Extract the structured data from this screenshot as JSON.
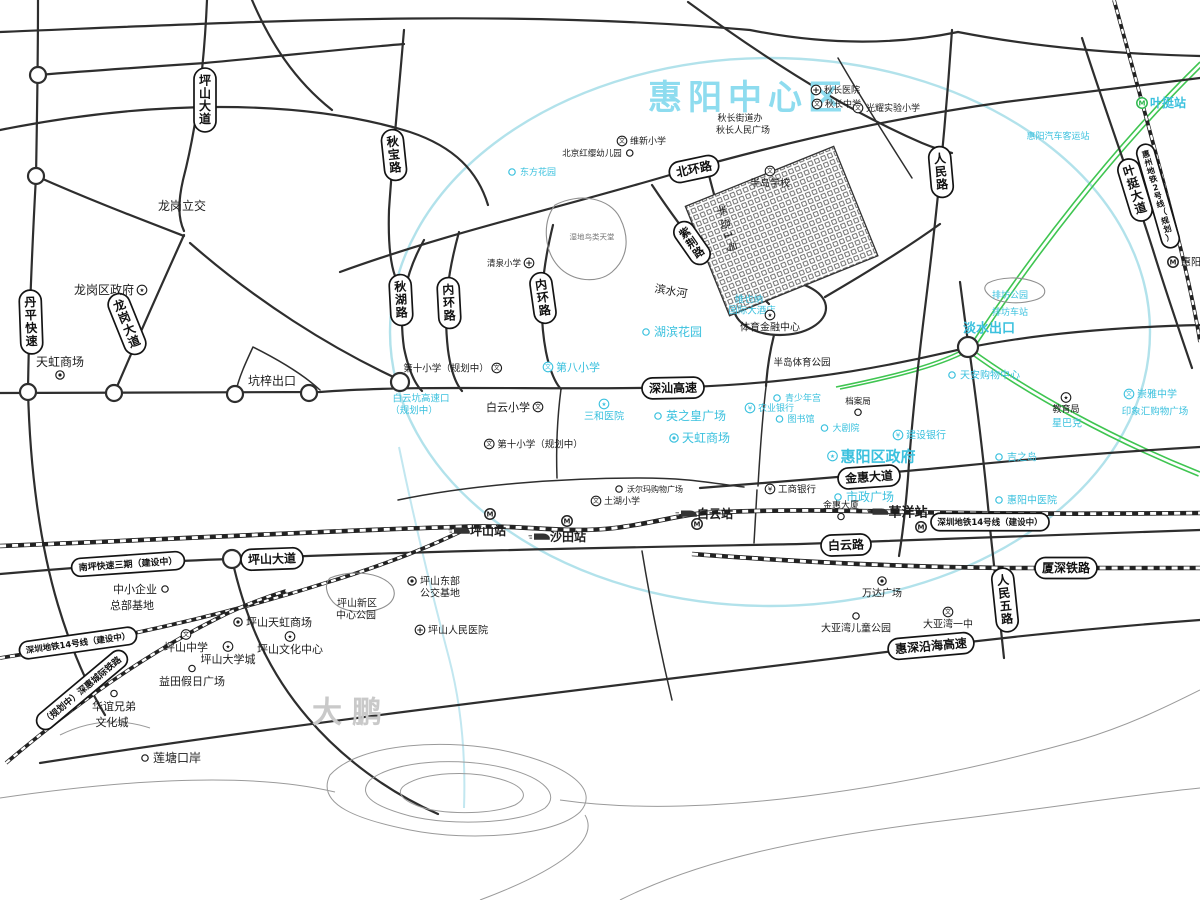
{
  "map": {
    "colors": {
      "cyan": "#3bc1de",
      "black": "#1c1c1c",
      "green": "#3fc551",
      "boundary": "#aadfe9"
    },
    "region_name": "惠阳中心区",
    "road_pills": [
      {
        "t": "坪山大道",
        "x": 205,
        "y": 100,
        "rot": 90,
        "fs": 12
      },
      {
        "t": "秋宝路",
        "x": 394,
        "y": 155,
        "rot": 84,
        "fs": 12
      },
      {
        "t": "秋湖路",
        "x": 401,
        "y": 300,
        "rot": 87,
        "fs": 12
      },
      {
        "t": "内环路",
        "x": 449,
        "y": 303,
        "rot": 87,
        "fs": 12
      },
      {
        "t": "内环路",
        "x": 543,
        "y": 298,
        "rot": 82,
        "fs": 12
      },
      {
        "t": "北环路",
        "x": 694,
        "y": 169,
        "rot": -12,
        "fs": 12
      },
      {
        "t": "紫荆路",
        "x": 692,
        "y": 243,
        "rot": 55,
        "fs": 11
      },
      {
        "t": "人民路",
        "x": 941,
        "y": 172,
        "rot": 85,
        "fs": 12
      },
      {
        "t": "深汕高速",
        "x": 673,
        "y": 388,
        "rot": -1,
        "fs": 12
      },
      {
        "t": "龙岗大道",
        "x": 127,
        "y": 324,
        "rot": 68,
        "fs": 12
      },
      {
        "t": "丹平快速",
        "x": 31,
        "y": 322,
        "rot": 88,
        "fs": 12
      },
      {
        "t": "金惠大道",
        "x": 869,
        "y": 477,
        "rot": -4,
        "fs": 12
      },
      {
        "t": "白云路",
        "x": 846,
        "y": 545,
        "rot": -2,
        "fs": 12
      },
      {
        "t": "坪山大道",
        "x": 272,
        "y": 559,
        "rot": -2,
        "fs": 12
      },
      {
        "t": "南坪快速三期（建设中）",
        "x": 128,
        "y": 564,
        "rot": -4,
        "fs": 9
      },
      {
        "t": "深圳地铁14号线（建设中）",
        "x": 78,
        "y": 643,
        "rot": -8,
        "fs": 8.5
      },
      {
        "t": "深圳地铁14号线（建设中）",
        "x": 990,
        "y": 522,
        "rot": 0,
        "fs": 8.5
      },
      {
        "t": "（规划中）深惠城际铁路",
        "x": 82,
        "y": 690,
        "rot": -40,
        "fs": 9
      },
      {
        "t": "厦深铁路",
        "x": 1066,
        "y": 568,
        "rot": 0,
        "fs": 12
      },
      {
        "t": "惠深沿海高速",
        "x": 931,
        "y": 646,
        "rot": -5,
        "fs": 12
      },
      {
        "t": "人民五路",
        "x": 1005,
        "y": 600,
        "rot": 84,
        "fs": 12
      },
      {
        "t": "叶挺大道",
        "x": 1135,
        "y": 190,
        "rot": 73,
        "fs": 12
      },
      {
        "t": "惠州地铁2号线（规划）",
        "x": 1158,
        "y": 196,
        "rot": 74,
        "fs": 8
      }
    ],
    "labels": [
      {
        "t": "惠阳中心区",
        "x": 748,
        "y": 97,
        "col": "#8edcef",
        "fs": 34,
        "b": 1,
        "ls": 6
      },
      {
        "t": "大鹏",
        "x": 352,
        "y": 712,
        "col": "#c9c9c9",
        "fs": 30,
        "b": 1,
        "ls": 10
      },
      {
        "t": "秋长医院",
        "x": 842,
        "y": 90,
        "c": "k",
        "ic": "hosp",
        "ip": "l",
        "fs": 9
      },
      {
        "t": "秋长中学",
        "x": 843,
        "y": 104,
        "c": "k",
        "ic": "school",
        "ip": "l",
        "fs": 9
      },
      {
        "t": "光耀实验小学",
        "x": 893,
        "y": 108,
        "c": "k",
        "ic": "school",
        "ip": "l",
        "fs": 9
      },
      {
        "t": "秋长街道办",
        "x": 740,
        "y": 118,
        "c": "k",
        "fs": 9
      },
      {
        "t": "秋长人民广场",
        "x": 743,
        "y": 130,
        "c": "k",
        "fs": 9
      },
      {
        "t": "维新小学",
        "x": 648,
        "y": 141,
        "c": "k",
        "ic": "school",
        "ip": "l",
        "fs": 9
      },
      {
        "t": "北京红缨幼儿园",
        "x": 592,
        "y": 153,
        "c": "k",
        "ic": "dot",
        "ip": "r",
        "fs": 8.5
      },
      {
        "t": "东方花园",
        "x": 538,
        "y": 172,
        "c": "c",
        "ic": "dot",
        "ip": "l",
        "fs": 9
      },
      {
        "t": "半岛学校",
        "x": 770,
        "y": 183,
        "c": "k",
        "ic": "school",
        "ip": "t",
        "fs": 10
      },
      {
        "t": "半岛1号",
        "x": 727,
        "y": 230,
        "c": "k",
        "fs": 11,
        "rot": 75,
        "ls": 3
      },
      {
        "t": "湿地鸟类天堂",
        "x": 592,
        "y": 237,
        "col": "#777777",
        "fs": 7.5
      },
      {
        "t": "清泉小学",
        "x": 504,
        "y": 263,
        "c": "k",
        "ic": "hosp",
        "ip": "r",
        "fs": 8.5
      },
      {
        "t": "滨水河",
        "x": 671,
        "y": 291,
        "c": "k",
        "fs": 11,
        "rot": 10
      },
      {
        "t": "排坊公园",
        "x": 1010,
        "y": 295,
        "c": "c",
        "fs": 9
      },
      {
        "t": "排坊车站",
        "x": 1010,
        "y": 312,
        "c": "c",
        "fs": 9
      },
      {
        "t": "淡水出口",
        "x": 989,
        "y": 328,
        "c": "c",
        "fs": 13,
        "b": 1
      },
      {
        "t": "维也纳",
        "x": 749,
        "y": 299,
        "c": "c",
        "fs": 9.5
      },
      {
        "t": "国际大酒店",
        "x": 752,
        "y": 310,
        "c": "c",
        "fs": 9.5
      },
      {
        "t": "体育金融中心",
        "x": 770,
        "y": 327,
        "c": "k",
        "ic": "gov",
        "ip": "t",
        "fs": 10
      },
      {
        "t": "湖滨花园",
        "x": 678,
        "y": 332,
        "c": "c",
        "ic": "dot",
        "ip": "l",
        "fs": 12
      },
      {
        "t": "半岛体育公园",
        "x": 802,
        "y": 362,
        "c": "k",
        "fs": 9.5
      },
      {
        "t": "第八小学",
        "x": 578,
        "y": 367,
        "c": "c",
        "ic": "school",
        "ip": "l",
        "fs": 11
      },
      {
        "t": "第十小学（规划中）",
        "x": 446,
        "y": 368,
        "c": "k",
        "ic": "school",
        "ip": "r",
        "fs": 9.5
      },
      {
        "t": "白云坑高速口",
        "x": 421,
        "y": 398,
        "c": "c",
        "fs": 9.5
      },
      {
        "t": "（规划中）",
        "x": 414,
        "y": 410,
        "c": "c",
        "fs": 9.5
      },
      {
        "t": "白云小学",
        "x": 508,
        "y": 407,
        "c": "k",
        "ic": "school",
        "ip": "r",
        "fs": 11
      },
      {
        "t": "第十小学（规划中）",
        "x": 540,
        "y": 444,
        "c": "k",
        "ic": "school",
        "ip": "l",
        "fs": 9.5
      },
      {
        "t": "三和医院",
        "x": 604,
        "y": 416,
        "c": "c",
        "ic": "gov",
        "ip": "t",
        "fs": 10
      },
      {
        "t": "英之皇广场",
        "x": 696,
        "y": 416,
        "c": "c",
        "ic": "dot",
        "ip": "l",
        "fs": 12
      },
      {
        "t": "天虹商场",
        "x": 706,
        "y": 438,
        "c": "c",
        "ic": "shop",
        "ip": "l",
        "fs": 12
      },
      {
        "t": "惠阳区政府",
        "x": 878,
        "y": 456,
        "c": "c",
        "ic": "gov",
        "ip": "l",
        "fs": 15,
        "b": 1
      },
      {
        "t": "青少年宫",
        "x": 803,
        "y": 398,
        "c": "c",
        "ic": "dot",
        "ip": "l",
        "fs": 9
      },
      {
        "t": "农业银行",
        "x": 776,
        "y": 408,
        "c": "c",
        "ic": "bank",
        "ip": "l",
        "fs": 9
      },
      {
        "t": "图书馆",
        "x": 801,
        "y": 419,
        "c": "c",
        "ic": "dot",
        "ip": "l",
        "fs": 9
      },
      {
        "t": "大剧院",
        "x": 846,
        "y": 428,
        "c": "c",
        "ic": "dot",
        "ip": "l",
        "fs": 9
      },
      {
        "t": "档案局",
        "x": 858,
        "y": 401,
        "c": "k",
        "ic": "dot",
        "ip": "b",
        "fs": 8.5
      },
      {
        "t": "建设银行",
        "x": 926,
        "y": 435,
        "c": "c",
        "ic": "bank",
        "ip": "l",
        "fs": 10
      },
      {
        "t": "市政广场",
        "x": 870,
        "y": 497,
        "c": "c",
        "ic": "dot",
        "ip": "l",
        "fs": 12
      },
      {
        "t": "工商银行",
        "x": 797,
        "y": 489,
        "c": "k",
        "ic": "bank",
        "ip": "l",
        "fs": 9.5
      },
      {
        "t": "金惠大厦",
        "x": 841,
        "y": 505,
        "c": "k",
        "ic": "dot",
        "ip": "b",
        "fs": 9
      },
      {
        "t": "教育局",
        "x": 1066,
        "y": 409,
        "c": "k",
        "ic": "gov",
        "ip": "t",
        "fs": 9
      },
      {
        "t": "星巴克",
        "x": 1067,
        "y": 423,
        "c": "c",
        "fs": 10
      },
      {
        "t": "吉之岛",
        "x": 1022,
        "y": 457,
        "c": "c",
        "ic": "dot",
        "ip": "l",
        "fs": 10
      },
      {
        "t": "天安购物中心",
        "x": 990,
        "y": 375,
        "c": "c",
        "ic": "dot",
        "ip": "l",
        "fs": 10
      },
      {
        "t": "惠阳中医院",
        "x": 1032,
        "y": 500,
        "c": "c",
        "ic": "dot",
        "ip": "l",
        "fs": 10
      },
      {
        "t": "崇雅中学",
        "x": 1157,
        "y": 394,
        "c": "c",
        "ic": "school",
        "ip": "l",
        "fs": 10
      },
      {
        "t": "印象汇购物广场",
        "x": 1155,
        "y": 411,
        "c": "c",
        "fs": 9.5
      },
      {
        "t": "惠阳汽车客运站",
        "x": 1058,
        "y": 136,
        "c": "c",
        "fs": 9
      },
      {
        "t": "叶挺站",
        "x": 1168,
        "y": 103,
        "c": "c",
        "ic": "metrog",
        "ip": "l",
        "fs": 12,
        "b": 1
      },
      {
        "t": "惠阳",
        "x": 1191,
        "y": 262,
        "c": "k",
        "ic": "metro",
        "ip": "l",
        "fs": 10
      },
      {
        "t": "土湖小学",
        "x": 622,
        "y": 501,
        "c": "k",
        "ic": "school",
        "ip": "l",
        "fs": 9
      },
      {
        "t": "沃尔玛购物广场",
        "x": 655,
        "y": 489,
        "c": "k",
        "ic": "dot",
        "ip": "l",
        "fs": 8
      },
      {
        "t": "龙岗立交",
        "x": 182,
        "y": 206,
        "c": "k",
        "fs": 12
      },
      {
        "t": "龙岗区政府",
        "x": 104,
        "y": 290,
        "c": "k",
        "ic": "gov",
        "ip": "r",
        "fs": 12
      },
      {
        "t": "天虹商场",
        "x": 60,
        "y": 362,
        "c": "k",
        "ic": "shop",
        "ip": "b",
        "fs": 12
      },
      {
        "t": "坑梓出口",
        "x": 272,
        "y": 381,
        "c": "k",
        "fs": 12
      },
      {
        "t": "中小企业",
        "x": 135,
        "y": 589,
        "c": "k",
        "ic": "dot",
        "ip": "r",
        "fs": 11
      },
      {
        "t": "总部基地",
        "x": 132,
        "y": 605,
        "c": "k",
        "fs": 11
      },
      {
        "t": "坪山东部",
        "x": 440,
        "y": 581,
        "c": "k",
        "ic": "shop",
        "ip": "l",
        "fs": 10
      },
      {
        "t": "公交基地",
        "x": 440,
        "y": 593,
        "c": "k",
        "fs": 10
      },
      {
        "t": "坪山新区",
        "x": 357,
        "y": 603,
        "c": "k",
        "fs": 10
      },
      {
        "t": "中心公园",
        "x": 356,
        "y": 615,
        "c": "k",
        "fs": 10
      },
      {
        "t": "坪山天虹商场",
        "x": 279,
        "y": 622,
        "c": "k",
        "ic": "shop",
        "ip": "l",
        "fs": 11
      },
      {
        "t": "坪山人民医院",
        "x": 458,
        "y": 630,
        "c": "k",
        "ic": "hosp",
        "ip": "l",
        "fs": 10
      },
      {
        "t": "坪山中学",
        "x": 186,
        "y": 647,
        "c": "k",
        "ic": "school",
        "ip": "t",
        "fs": 11
      },
      {
        "t": "坪山大学城",
        "x": 228,
        "y": 659,
        "c": "k",
        "ic": "gov",
        "ip": "t",
        "fs": 11
      },
      {
        "t": "坪山文化中心",
        "x": 290,
        "y": 649,
        "c": "k",
        "ic": "gov",
        "ip": "t",
        "fs": 11
      },
      {
        "t": "益田假日广场",
        "x": 192,
        "y": 681,
        "c": "k",
        "ic": "dot",
        "ip": "t",
        "fs": 11
      },
      {
        "t": "华谊兄弟",
        "x": 114,
        "y": 706,
        "c": "k",
        "ic": "dot",
        "ip": "t",
        "fs": 11
      },
      {
        "t": "文化城",
        "x": 112,
        "y": 722,
        "c": "k",
        "fs": 11
      },
      {
        "t": "莲塘口岸",
        "x": 177,
        "y": 758,
        "c": "k",
        "ic": "dot",
        "ip": "l",
        "fs": 12
      },
      {
        "t": "万达广场",
        "x": 882,
        "y": 593,
        "c": "k",
        "ic": "shop",
        "ip": "t",
        "fs": 10
      },
      {
        "t": "大亚湾儿童公园",
        "x": 856,
        "y": 628,
        "c": "k",
        "ic": "dot",
        "ip": "t",
        "fs": 10
      },
      {
        "t": "大亚湾一中",
        "x": 948,
        "y": 624,
        "c": "k",
        "ic": "school",
        "ip": "t",
        "fs": 10
      },
      {
        "t": "坪山站",
        "x": 488,
        "y": 531,
        "c": "k",
        "ic": "train",
        "ip": "l",
        "fs": 12,
        "b": 1
      },
      {
        "t": "沙田站",
        "x": 568,
        "y": 537,
        "c": "k",
        "ic": "train",
        "ip": "l",
        "fs": 12,
        "b": 1
      },
      {
        "t": "白云站",
        "x": 715,
        "y": 514,
        "c": "k",
        "ic": "train",
        "ip": "l",
        "fs": 12,
        "b": 1
      },
      {
        "t": "草洋站",
        "x": 908,
        "y": 512,
        "c": "k",
        "ic": "train",
        "ip": "l",
        "fs": 13,
        "b": 1
      },
      {
        "t": "",
        "x": 490,
        "y": 514,
        "c": "k",
        "ic": "metro",
        "fs": 10
      },
      {
        "t": "",
        "x": 567,
        "y": 521,
        "c": "k",
        "ic": "metro",
        "fs": 10
      },
      {
        "t": "",
        "x": 697,
        "y": 524,
        "c": "k",
        "ic": "metro",
        "fs": 10
      },
      {
        "t": "",
        "x": 921,
        "y": 527,
        "c": "k",
        "ic": "metro",
        "fs": 10
      }
    ]
  }
}
